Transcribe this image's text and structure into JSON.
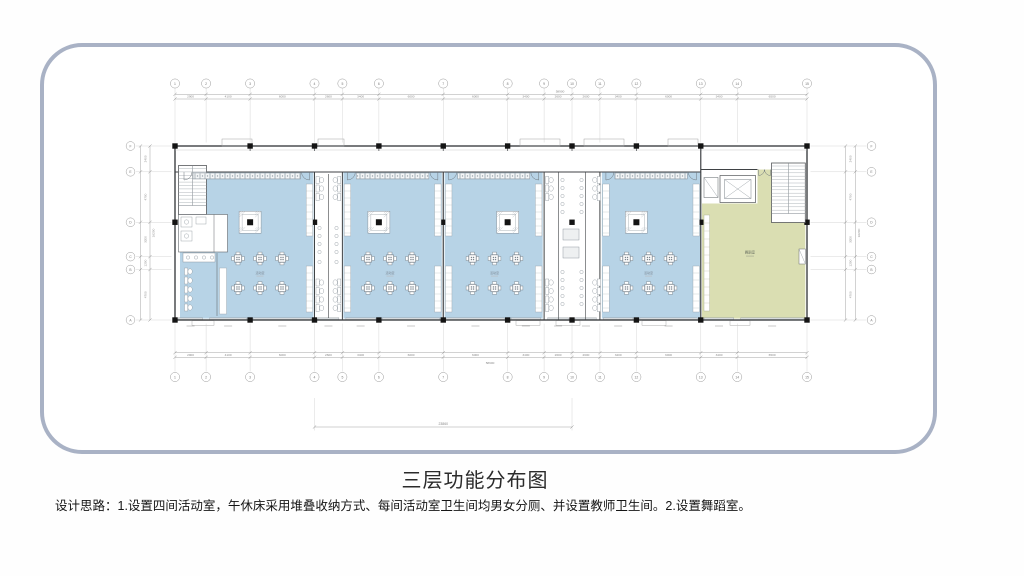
{
  "board": {
    "border_color": "#a9b2c5",
    "background": "#ffffff"
  },
  "title": {
    "text": "三层功能分布图"
  },
  "caption": {
    "text": "设计思路：1.设置四间活动室，午休床采用堆叠收纳方式、每间活动室卫生间均男女分厕、并设置教师卫生间。2.设置舞蹈室。"
  },
  "plan": {
    "colors": {
      "activity_room": "#b7d3e6",
      "dance_room": "#dadeb2",
      "wall": "#3f4245",
      "column": "#141414",
      "furniture": "#8a939b",
      "dim_line": "#9b9b9b",
      "dim_text": "#8a8a8a",
      "room_label": "#7d8894",
      "dance_label": "#6b7162"
    },
    "column_grid": {
      "labels": [
        "1",
        "2",
        "3",
        "4",
        "5",
        "6",
        "7",
        "8",
        "9",
        "10",
        "11",
        "12",
        "13",
        "14",
        "15"
      ],
      "spacings_mm": [
        2900,
        4100,
        6000,
        2600,
        3400,
        6000,
        6000,
        3400,
        2600,
        2600,
        3400,
        6000,
        3400,
        6500
      ],
      "total_label": "58900"
    },
    "row_grid": {
      "labels": [
        "F",
        "E",
        "D",
        "C",
        "B",
        "A"
      ],
      "spacings_mm": [
        2400,
        4700,
        3200,
        1200,
        4700
      ],
      "total_label": "16200"
    },
    "partial_width_label": "23860",
    "rooms": [
      {
        "name": "活动室",
        "type": "activity"
      },
      {
        "name": "活动室",
        "type": "activity"
      },
      {
        "name": "活动室",
        "type": "activity"
      },
      {
        "name": "活动室",
        "type": "activity"
      },
      {
        "name": "舞蹈室",
        "type": "dance"
      }
    ]
  }
}
